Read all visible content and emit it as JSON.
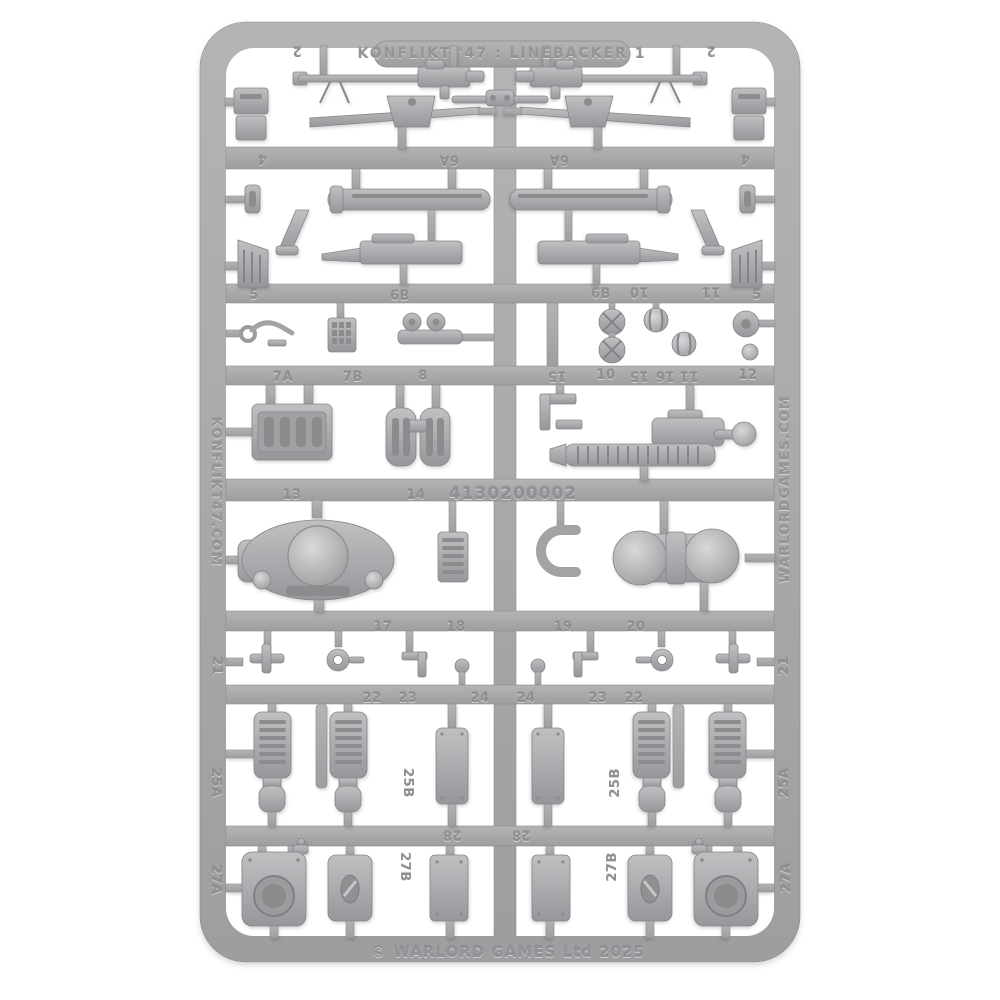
{
  "image": {
    "type": "photograph",
    "subject": "grey plastic model kit sprue on white background"
  },
  "sprue": {
    "title": "KONFLIKT '47 : LINEBACKER 1",
    "catalog_number": "4130200002",
    "copyright": "© WARLORD GAMES Ltd 2025",
    "left_rail_url": "KONFLIKT47.COM",
    "right_rail_url": "WARLORDGAMES.COM",
    "colors": {
      "plastic": "#a9abad",
      "plastic_light": "#bfc0c2",
      "plastic_dark": "#8f9092",
      "background": "#ffffff"
    },
    "part_labels": [
      {
        "text": "2"
      },
      {
        "text": "2"
      },
      {
        "text": "4"
      },
      {
        "text": "6A"
      },
      {
        "text": "6A"
      },
      {
        "text": "4"
      },
      {
        "text": "5"
      },
      {
        "text": "6B"
      },
      {
        "text": "6B"
      },
      {
        "text": "10"
      },
      {
        "text": "11"
      },
      {
        "text": "5"
      },
      {
        "text": "7A"
      },
      {
        "text": "7B"
      },
      {
        "text": "8"
      },
      {
        "text": "15"
      },
      {
        "text": "10"
      },
      {
        "text": "15"
      },
      {
        "text": "16"
      },
      {
        "text": "11"
      },
      {
        "text": "12"
      },
      {
        "text": "13"
      },
      {
        "text": "14"
      },
      {
        "text": "17"
      },
      {
        "text": "18"
      },
      {
        "text": "19"
      },
      {
        "text": "20"
      },
      {
        "text": "21"
      },
      {
        "text": "22"
      },
      {
        "text": "23"
      },
      {
        "text": "24"
      },
      {
        "text": "24"
      },
      {
        "text": "23"
      },
      {
        "text": "22"
      },
      {
        "text": "21"
      },
      {
        "text": "25A"
      },
      {
        "text": "25B"
      },
      {
        "text": "25B"
      },
      {
        "text": "25A"
      },
      {
        "text": "28"
      },
      {
        "text": "28"
      },
      {
        "text": "27B"
      },
      {
        "text": "27B"
      },
      {
        "text": "27A"
      },
      {
        "text": "27A"
      }
    ]
  }
}
